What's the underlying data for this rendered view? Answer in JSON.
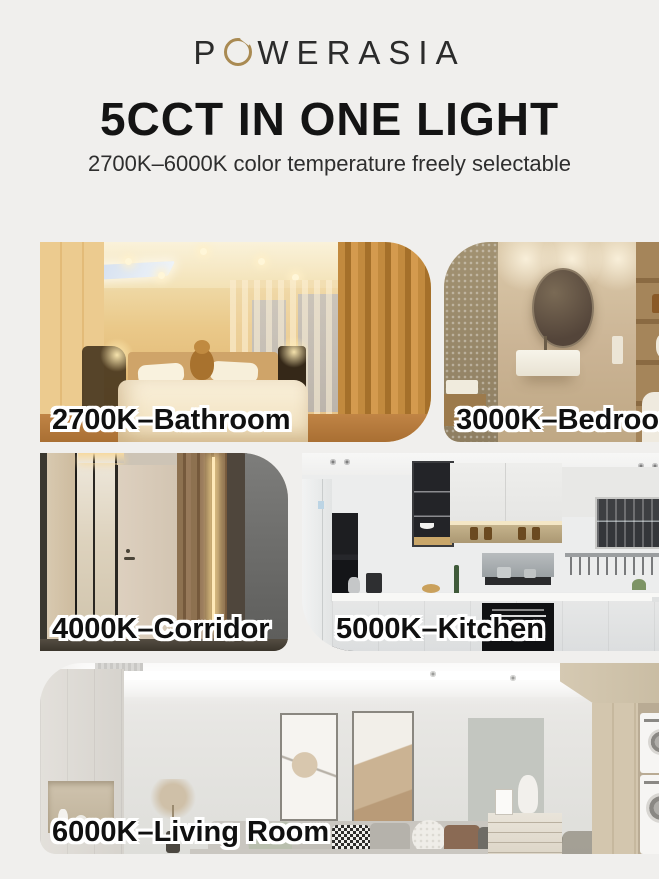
{
  "header": {
    "brand": "POWERASIA",
    "brand_p": "P",
    "brand_rest": "WERASIA",
    "title": "5CCT IN ONE LIGHT",
    "subtitle": "2700K–6000K color temperature freely selectable"
  },
  "tiles": [
    {
      "label": "2700K–Bathroom"
    },
    {
      "label": "3000K–Bedroom"
    },
    {
      "label": "4000K–Corridor"
    },
    {
      "label": "5000K–Kitchen"
    },
    {
      "label": "6000K–Living Room"
    }
  ],
  "colors": {
    "background": "#f0efed",
    "accent_gold": "#a98a52",
    "title_text": "#141414",
    "label_fill": "#101010",
    "label_outline": "#ffffff",
    "cct_tones": {
      "2700K": "#e2b873",
      "3000K": "#cab394",
      "4000K": "#cdc4b6",
      "5000K": "#eceded",
      "6000K": "#e7e6e3"
    }
  }
}
